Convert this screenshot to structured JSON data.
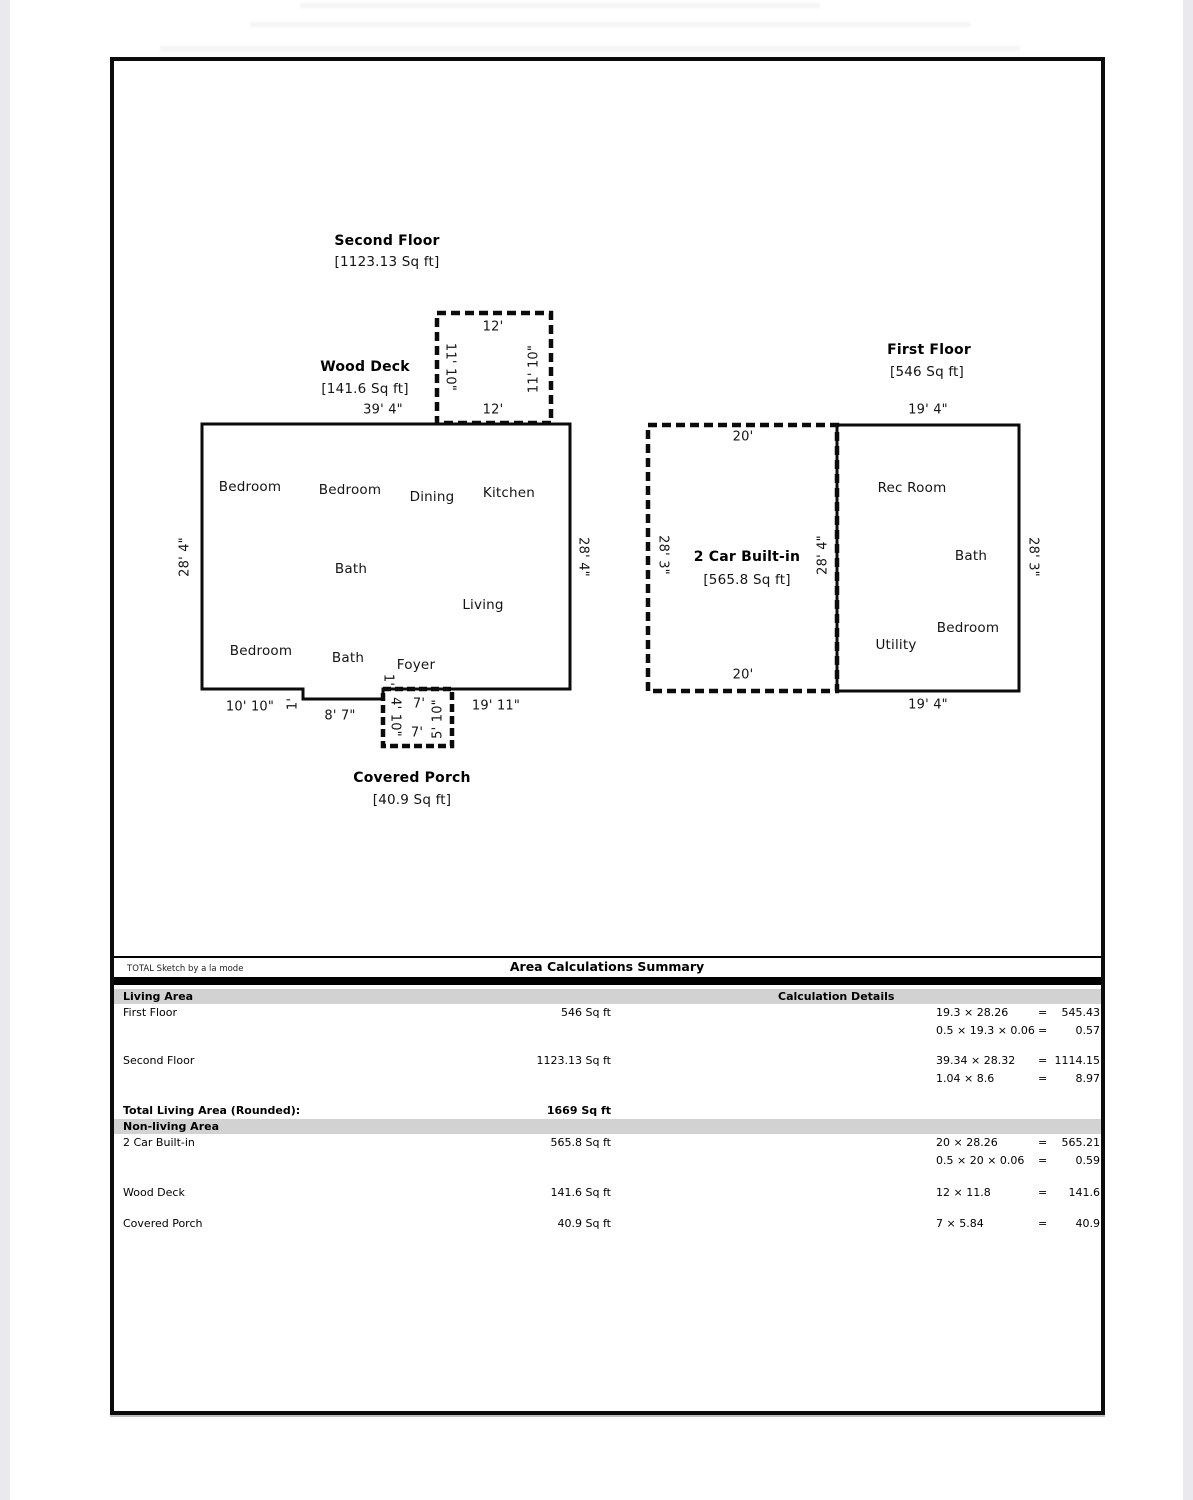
{
  "sketch": {
    "second_floor": {
      "title": "Second Floor",
      "area": "[1123.13 Sq ft]",
      "side_left": "28' 4\"",
      "side_right": "28' 4\"",
      "rooms": [
        "Bedroom",
        "Bedroom",
        "Dining",
        "Kitchen",
        "Bath",
        "Living",
        "Bedroom",
        "Bath",
        "Foyer"
      ],
      "dims": {
        "bottom_left": "10' 10\"",
        "step": "1'",
        "bottom_mid": "8' 7\"",
        "bottom_right": "19' 11\""
      },
      "deck": {
        "title": "Wood Deck",
        "area": "[141.6 Sq ft]",
        "width": "39' 4\"",
        "top": "12'",
        "bottom": "12'",
        "left": "11' 10\"",
        "right": "11' 10\""
      },
      "porch": {
        "title": "Covered Porch",
        "area": "[40.9 Sq ft]",
        "step": "1'",
        "left": "4' 10\"",
        "right": "5' 10\"",
        "top": "7'",
        "bottom": "7'"
      }
    },
    "first_floor": {
      "title": "First Floor",
      "area": "[546 Sq ft]",
      "top": "19' 4\"",
      "bottom": "19' 4\"",
      "side_right": "28' 3\"",
      "shared_wall": "28' 4\"",
      "rooms": [
        "Rec Room",
        "Bath",
        "Bedroom",
        "Utility"
      ],
      "garage": {
        "title": "2 Car Built-in",
        "area": "[565.8 Sq ft]",
        "top": "20'",
        "bottom": "20'",
        "left": "28' 3\""
      }
    }
  },
  "table": {
    "brand": "TOTAL Sketch by a la mode",
    "title": "Area Calculations Summary",
    "living_header": "Living Area",
    "calc_header": "Calculation Details",
    "nonliving_header": "Non-living Area",
    "total_label": "Total Living Area (Rounded):",
    "total_value": "1669 Sq ft",
    "living_rows": [
      {
        "name": "First Floor",
        "area": "546 Sq ft",
        "calcs": [
          {
            "f": "19.3 × 28.26",
            "eq": "=",
            "v": "545.43"
          },
          {
            "f": "0.5 × 19.3 × 0.06",
            "eq": "=",
            "v": "0.57"
          }
        ]
      },
      {
        "name": "Second Floor",
        "area": "1123.13 Sq ft",
        "calcs": [
          {
            "f": "39.34 × 28.32",
            "eq": "=",
            "v": "1114.15"
          },
          {
            "f": "1.04 × 8.6",
            "eq": "=",
            "v": "8.97"
          }
        ]
      }
    ],
    "nonliving_rows": [
      {
        "name": "2 Car Built-in",
        "area": "565.8 Sq ft",
        "calcs": [
          {
            "f": "20 × 28.26",
            "eq": "=",
            "v": "565.21"
          },
          {
            "f": "0.5 × 20 × 0.06",
            "eq": "=",
            "v": "0.59"
          }
        ]
      },
      {
        "name": "Wood Deck",
        "area": "141.6 Sq ft",
        "calcs": [
          {
            "f": "12 × 11.8",
            "eq": "=",
            "v": "141.6"
          }
        ]
      },
      {
        "name": "Covered Porch",
        "area": "40.9 Sq ft",
        "calcs": [
          {
            "f": "7 × 5.84",
            "eq": "=",
            "v": "40.9"
          }
        ]
      }
    ]
  }
}
